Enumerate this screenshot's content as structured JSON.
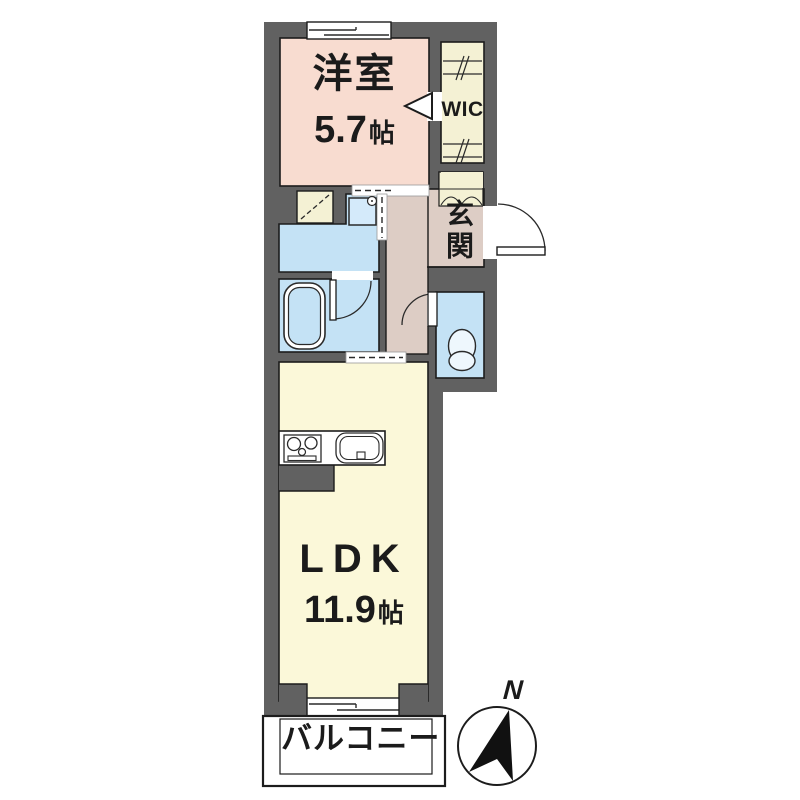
{
  "rooms": {
    "bedroom": {
      "label": "洋室",
      "area": "5.7",
      "area_unit": "帖"
    },
    "wic": {
      "label": "WIC"
    },
    "genkan": {
      "label": "玄関"
    },
    "ldk": {
      "label": "LDK",
      "area": "11.9",
      "area_unit": "帖"
    },
    "balcony": {
      "label": "バルコニー"
    }
  },
  "compass": {
    "north_label": "N"
  },
  "icons": [
    "north-arrow-icon",
    "bathtub-icon",
    "toilet-icon",
    "washbasin-icon",
    "stove-icon",
    "sink-icon",
    "hanger-rod-icon",
    "door-swing-icon",
    "sliding-door-icon",
    "folding-door-icon",
    "window-icon",
    "opening-arrow-icon"
  ],
  "colors": {
    "wall": "#616161",
    "bedroom": "#f8dcd0",
    "closet_cream": "#f4f1d4",
    "hall_beige": "#ddcdc5",
    "wet_blue": "#c4e2f5",
    "ldk_yellow": "#fbf8d9",
    "outline": "#1c1c1c",
    "background": "#ffffff"
  }
}
